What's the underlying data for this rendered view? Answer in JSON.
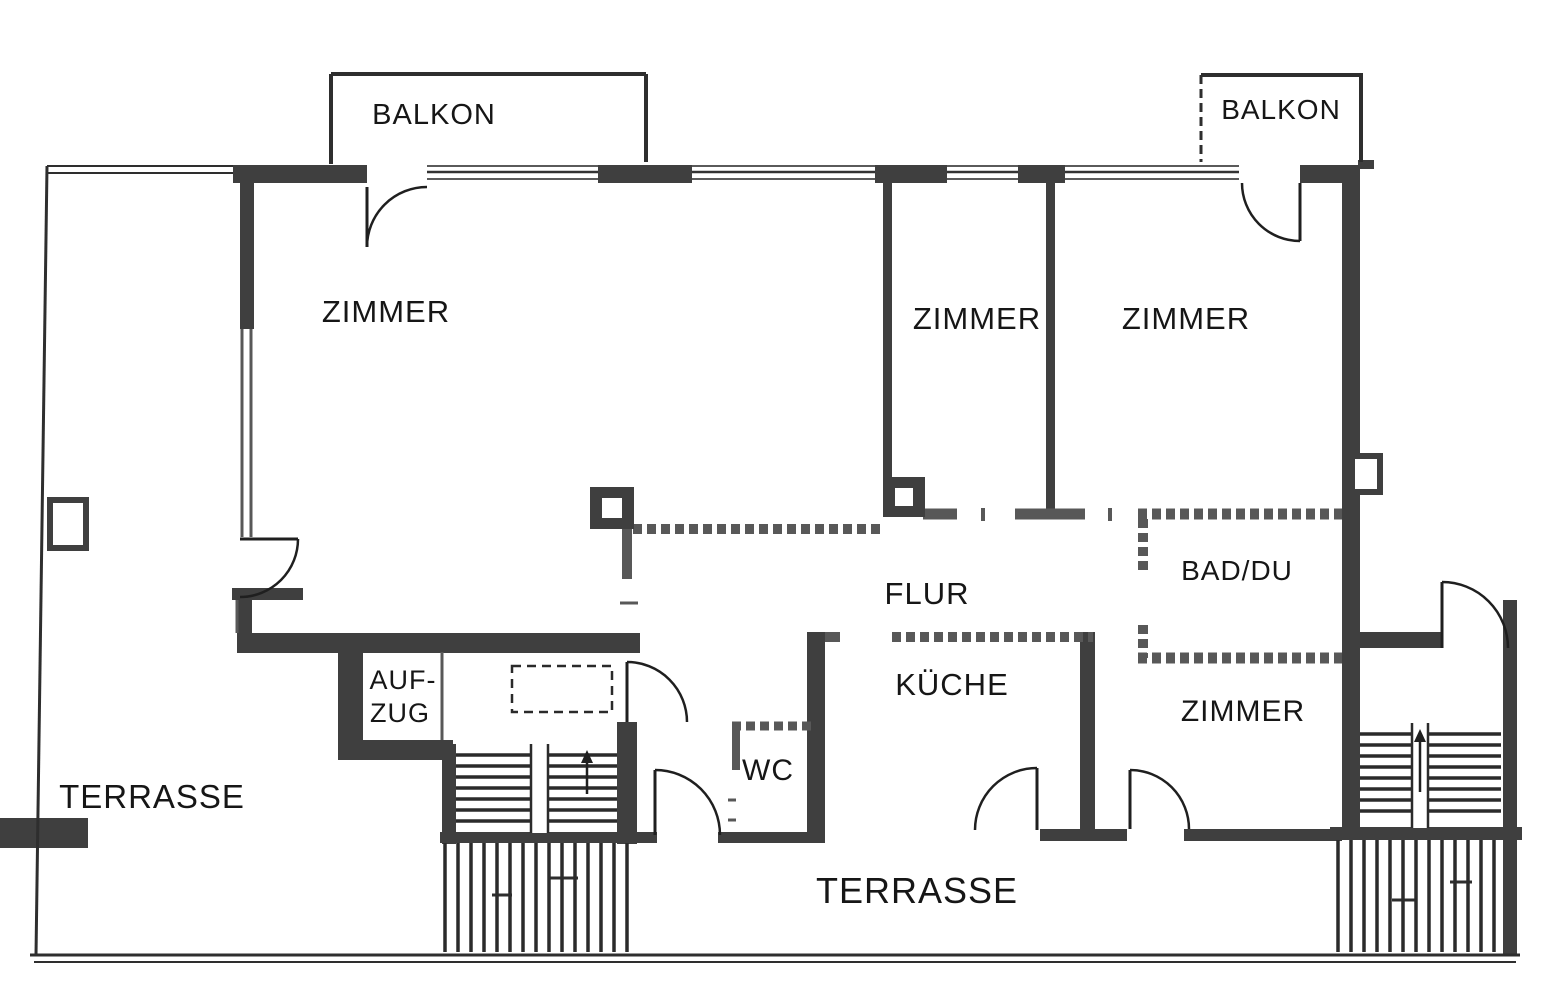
{
  "meta": {
    "type": "scanned-floor-plan",
    "language": "de"
  },
  "palette": {
    "background": "#ffffff",
    "wall_dark": "#3f3f3f",
    "wall_mid": "#585858",
    "line": "#2e2e2e",
    "text": "#161616"
  },
  "rooms": [
    {
      "id": "balkon-left",
      "label": "BALKON"
    },
    {
      "id": "balkon-right",
      "label": "BALKON"
    },
    {
      "id": "zimmer-large",
      "label": "ZIMMER"
    },
    {
      "id": "zimmer-middle",
      "label": "ZIMMER"
    },
    {
      "id": "zimmer-right",
      "label": "ZIMMER"
    },
    {
      "id": "flur",
      "label": "FLUR"
    },
    {
      "id": "bad-du",
      "label": "BAD/DU"
    },
    {
      "id": "kueche",
      "label": "KÜCHE"
    },
    {
      "id": "zimmer-south",
      "label": "ZIMMER"
    },
    {
      "id": "wc",
      "label": "WC"
    },
    {
      "id": "aufzug",
      "label": "AUF-ZUG"
    },
    {
      "id": "terrasse-west",
      "label": "TERRASSE"
    },
    {
      "id": "terrasse-south",
      "label": "TERRASSE"
    }
  ],
  "plan": {
    "labels": [
      {
        "id": "balkon-left",
        "text": "BALKON",
        "x": 434,
        "y": 124,
        "size": 29
      },
      {
        "id": "balkon-right",
        "text": "BALKON",
        "x": 1281,
        "y": 119,
        "size": 28
      },
      {
        "id": "zimmer-large",
        "text": "ZIMMER",
        "x": 386,
        "y": 322,
        "size": 31
      },
      {
        "id": "zimmer-middle",
        "text": "ZIMMER",
        "x": 977,
        "y": 329,
        "size": 31
      },
      {
        "id": "zimmer-right",
        "text": "ZIMMER",
        "x": 1186,
        "y": 329,
        "size": 31
      },
      {
        "id": "flur",
        "text": "FLUR",
        "x": 927,
        "y": 604,
        "size": 31
      },
      {
        "id": "bad-du",
        "text": "BAD/DU",
        "x": 1237,
        "y": 580,
        "size": 28
      },
      {
        "id": "kueche",
        "text": "KÜCHE",
        "x": 952,
        "y": 695,
        "size": 31
      },
      {
        "id": "zimmer-south",
        "text": "ZIMMER",
        "x": 1243,
        "y": 721,
        "size": 30
      },
      {
        "id": "wc",
        "text": "WC",
        "x": 768,
        "y": 780,
        "size": 30
      },
      {
        "id": "aufzug-line1",
        "text": "AUF-",
        "x": 403,
        "y": 689,
        "size": 27
      },
      {
        "id": "aufzug-line2",
        "text": "ZUG",
        "x": 400,
        "y": 722,
        "size": 27
      },
      {
        "id": "terrasse-west",
        "text": "TERRASSE",
        "x": 152,
        "y": 808,
        "size": 33
      },
      {
        "id": "terrasse-south",
        "text": "TERRASSE",
        "x": 917,
        "y": 903,
        "size": 36
      }
    ],
    "walls": [
      [
        233,
        165,
        134,
        18
      ],
      [
        598,
        165,
        94,
        18
      ],
      [
        875,
        165,
        72,
        18
      ],
      [
        1018,
        165,
        47,
        18
      ],
      [
        1300,
        165,
        60,
        18
      ],
      [
        1342,
        165,
        18,
        675
      ],
      [
        240,
        165,
        14,
        164
      ],
      [
        237,
        633,
        403,
        20
      ],
      [
        237,
        595,
        15,
        42
      ],
      [
        338,
        637,
        25,
        123
      ],
      [
        338,
        740,
        115,
        20
      ],
      [
        442,
        744,
        14,
        100
      ],
      [
        617,
        722,
        20,
        122
      ],
      [
        440,
        832,
        217,
        11
      ],
      [
        718,
        832,
        89,
        11
      ],
      [
        807,
        632,
        18,
        211
      ],
      [
        1080,
        632,
        15,
        200
      ],
      [
        1040,
        829,
        87,
        12
      ],
      [
        1184,
        829,
        158,
        12
      ],
      [
        883,
        183,
        9,
        294
      ],
      [
        1046,
        183,
        9,
        332
      ],
      [
        1360,
        632,
        82,
        16
      ],
      [
        1503,
        600,
        14,
        356
      ],
      [
        0,
        818,
        88,
        30
      ],
      [
        1330,
        827,
        192,
        13
      ],
      [
        1358,
        160,
        16,
        9
      ],
      [
        232,
        588,
        71,
        12
      ]
    ],
    "thin_walls": [
      [
        633,
        529,
        883,
        529,
        10,
        1
      ],
      [
        923,
        514,
        957,
        514,
        11,
        0
      ],
      [
        1015,
        514,
        1085,
        514,
        11,
        0
      ],
      [
        983,
        508,
        983,
        521,
        4,
        0
      ],
      [
        1110,
        508,
        1110,
        521,
        4,
        0
      ],
      [
        1138,
        514,
        1342,
        514,
        11,
        1
      ],
      [
        1143,
        519,
        1143,
        575,
        10,
        1
      ],
      [
        1143,
        625,
        1143,
        658,
        10,
        1
      ],
      [
        1138,
        658,
        1342,
        658,
        11,
        1
      ],
      [
        825,
        637,
        840,
        637,
        10,
        0
      ],
      [
        892,
        637,
        1093,
        637,
        10,
        1
      ],
      [
        732,
        726,
        815,
        726,
        9,
        1
      ],
      [
        736,
        726,
        736,
        770,
        8,
        0
      ],
      [
        627,
        527,
        627,
        579,
        10,
        0
      ],
      [
        242,
        329,
        242,
        537,
        3,
        0
      ],
      [
        251,
        329,
        251,
        537,
        3,
        0
      ],
      [
        237,
        600,
        237,
        633,
        3,
        0
      ],
      [
        442,
        652,
        442,
        740,
        3,
        0
      ],
      [
        620,
        603,
        638,
        603,
        3,
        0
      ],
      [
        728,
        800,
        736,
        800,
        3,
        0
      ],
      [
        728,
        820,
        736,
        820,
        3,
        0
      ]
    ],
    "lines": [
      [
        47,
        166,
        36,
        955,
        3,
        0
      ],
      [
        30,
        955,
        1520,
        955,
        3,
        0
      ],
      [
        34,
        962,
        1516,
        962,
        2,
        0
      ],
      [
        47,
        166,
        233,
        166,
        2,
        0
      ],
      [
        47,
        173,
        233,
        173,
        2,
        0
      ],
      [
        331,
        74,
        646,
        74,
        4,
        0
      ],
      [
        331,
        74,
        331,
        164,
        4,
        0
      ],
      [
        646,
        74,
        646,
        162,
        4,
        0
      ],
      [
        1201,
        75,
        1363,
        75,
        4,
        0
      ],
      [
        1201,
        75,
        1201,
        162,
        3,
        1
      ],
      [
        1361,
        75,
        1361,
        162,
        4,
        0
      ],
      [
        492,
        895,
        512,
        895,
        3,
        0
      ],
      [
        549,
        878,
        578,
        878,
        3,
        0
      ],
      [
        1392,
        900,
        1416,
        900,
        3,
        0
      ],
      [
        1450,
        882,
        1472,
        882,
        3,
        0
      ]
    ],
    "windows": [
      [
        427,
        598
      ],
      [
        692,
        875
      ],
      [
        947,
        1018
      ],
      [
        1065,
        1239
      ]
    ],
    "window_rows": [
      166,
      172,
      179
    ],
    "doors": [
      {
        "id": "door-balcony-left",
        "leaf": [
          367,
          187,
          367,
          247
        ],
        "arc": [
          367,
          247,
          60,
          427,
          187,
          1
        ]
      },
      {
        "id": "door-balcony-right",
        "leaf": [
          1300,
          183,
          1300,
          241
        ],
        "arc": [
          1300,
          241,
          58,
          1242,
          183,
          1
        ]
      },
      {
        "id": "door-west-room",
        "leaf": [
          240,
          539,
          298,
          539
        ],
        "arc": [
          298,
          539,
          58,
          240,
          597,
          1
        ]
      },
      {
        "id": "door-stairwell",
        "leaf": [
          627,
          662,
          627,
          722
        ],
        "arc": [
          627,
          662,
          60,
          687,
          722,
          1
        ]
      },
      {
        "id": "door-entrance",
        "leaf": [
          655,
          770,
          655,
          835
        ],
        "arc": [
          655,
          770,
          65,
          720,
          835,
          1
        ]
      },
      {
        "id": "door-kitchen",
        "leaf": [
          1037,
          768,
          1037,
          830
        ],
        "arc": [
          975,
          830,
          62,
          1037,
          768,
          1
        ]
      },
      {
        "id": "door-zimmer-south",
        "leaf": [
          1130,
          770,
          1130,
          829
        ],
        "arc": [
          1130,
          770,
          59,
          1189,
          829,
          1
        ]
      },
      {
        "id": "door-terrace-east",
        "leaf": [
          1442,
          582,
          1442,
          648
        ],
        "arc": [
          1442,
          582,
          66,
          1508,
          648,
          1
        ]
      }
    ],
    "pillars": [
      [
        590,
        487,
        44,
        42
      ],
      [
        883,
        477,
        42,
        40
      ]
    ],
    "fixtures": [
      [
        50,
        500,
        36,
        48
      ],
      [
        1352,
        456,
        28,
        36
      ]
    ],
    "dashed_rects": [
      [
        512,
        666,
        100,
        46
      ]
    ],
    "stairs": [
      {
        "x1": 456,
        "x2": 617,
        "ys": [
          755,
          766,
          777,
          788,
          799,
          810,
          821
        ],
        "stringer": [
          531,
          744,
          17,
          89
        ]
      },
      {
        "x1": 1360,
        "x2": 1501,
        "ys": [
          734,
          745,
          756,
          767,
          778,
          789,
          800,
          811
        ],
        "stringer": [
          1412,
          723,
          16,
          105
        ]
      }
    ],
    "arrows": [
      {
        "x": 587,
        "ytip": 750,
        "ybase": 794
      },
      {
        "x": 1420,
        "ytip": 729,
        "ybase": 792
      }
    ],
    "hatches": [
      {
        "y1": 843,
        "y2": 952,
        "xs": [
          445,
          458,
          471,
          484,
          497,
          510,
          523,
          536,
          549,
          562,
          575,
          588,
          601,
          614,
          627
        ]
      },
      {
        "y1": 840,
        "y2": 952,
        "xs": [
          1338,
          1351,
          1364,
          1377,
          1390,
          1403,
          1416,
          1429,
          1442,
          1455,
          1468,
          1481,
          1494
        ]
      }
    ]
  }
}
